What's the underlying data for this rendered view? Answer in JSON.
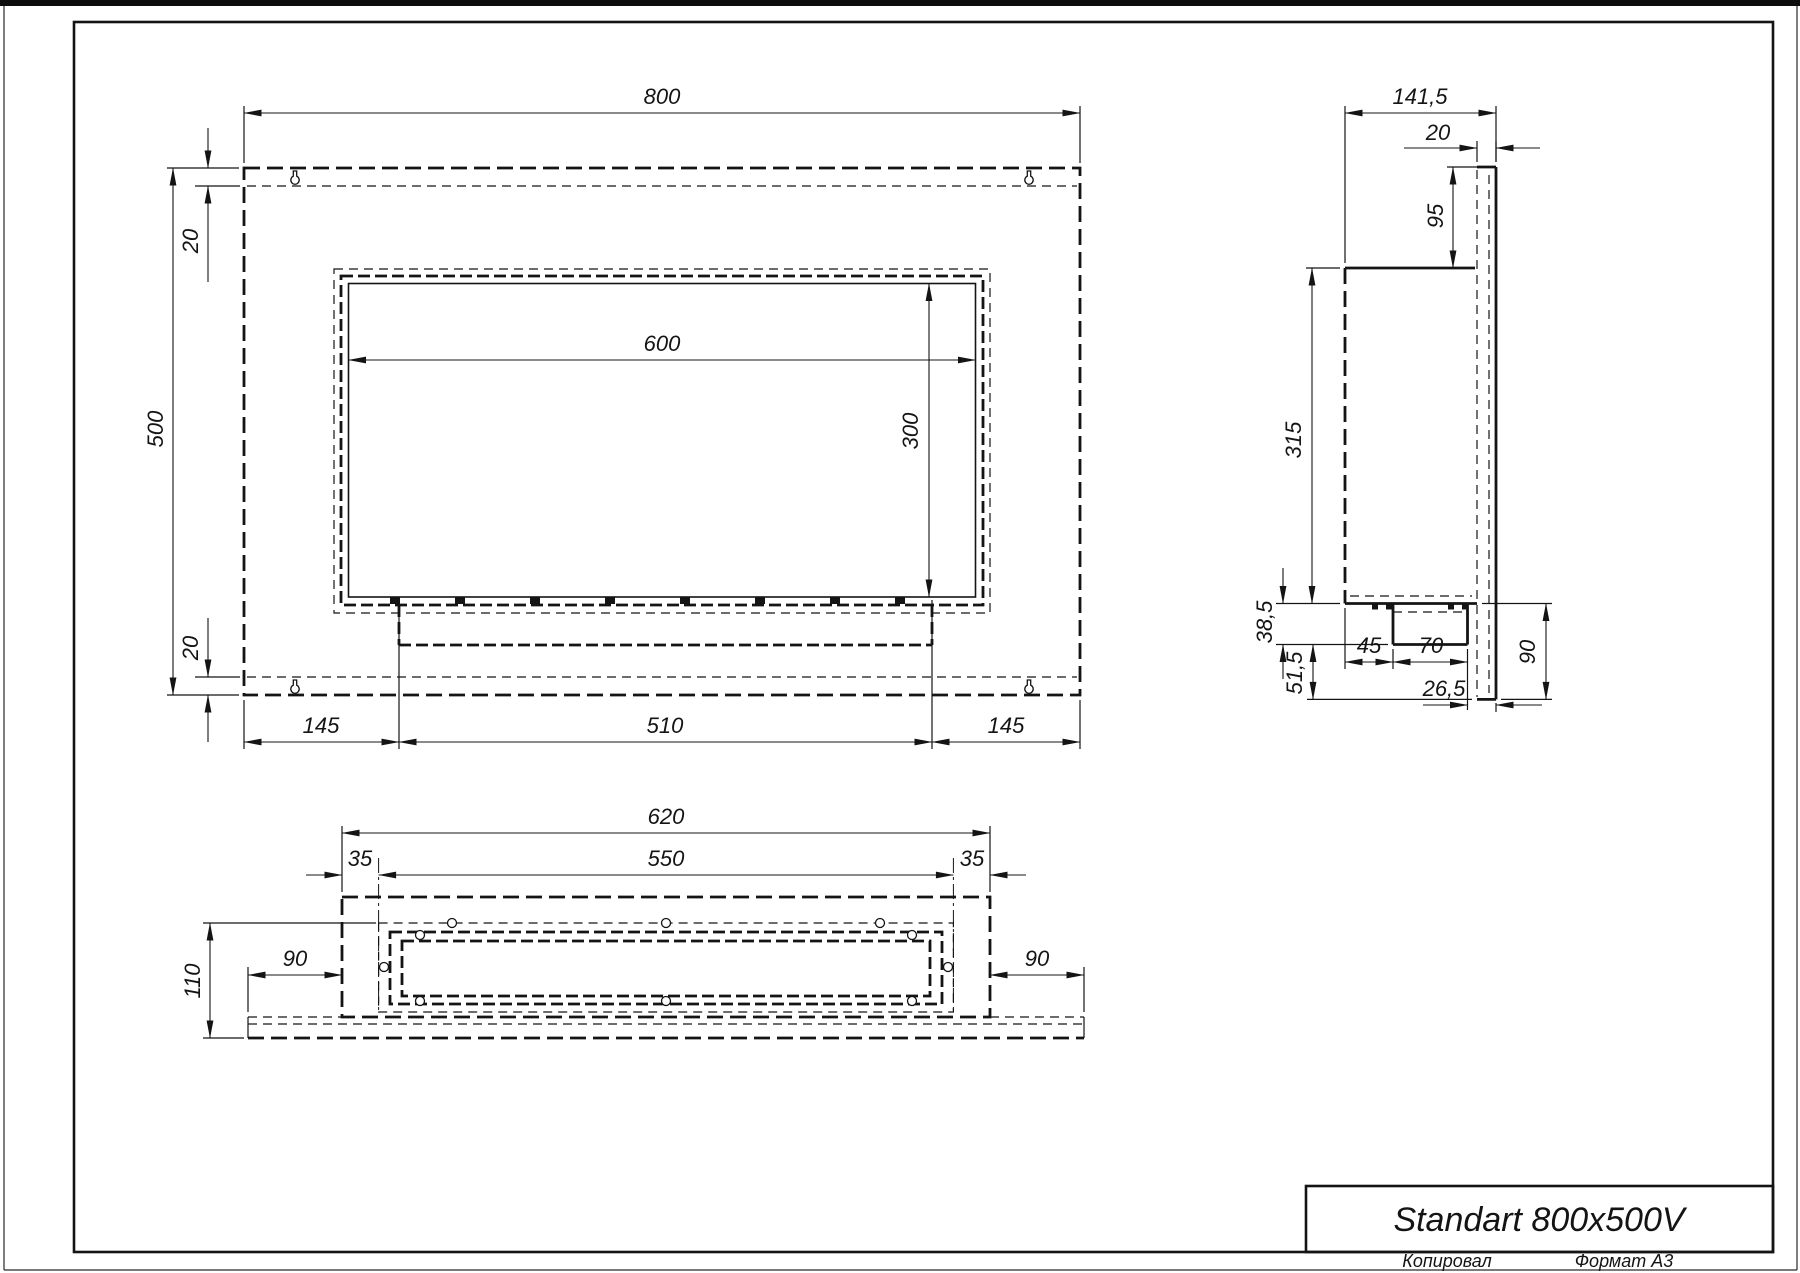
{
  "drawing": {
    "kind": "technical-drawing",
    "sheet_format": "A3",
    "line_color": "#141414",
    "background": "#ffffff"
  },
  "title_block": {
    "title": "Standart 800x500V",
    "footer_left": "Копировал",
    "footer_right": "Формат А3"
  },
  "views": {
    "front": {
      "name": "front view",
      "dims": {
        "width": "800",
        "height": "500",
        "margin_top": "20",
        "margin_bottom": "20",
        "opening_width": "600",
        "opening_height": "300",
        "side_left": "145",
        "tray_width": "510",
        "side_right": "145"
      }
    },
    "side": {
      "name": "side view",
      "dims": {
        "depth": "141,5",
        "plate_thickness": "20",
        "top_offset": "95",
        "body_height": "315",
        "burner_drop": "38,5",
        "lower_gap": "51,5",
        "burner_offset": "45",
        "burner_width": "70",
        "back_gap": "26,5",
        "lower_height": "90"
      }
    },
    "bottom": {
      "name": "bottom view",
      "dims": {
        "outer_width": "620",
        "inner_width": "550",
        "flange_left": "35",
        "flange_right": "35",
        "depth": "110",
        "wing_left": "90",
        "wing_right": "90"
      }
    }
  }
}
